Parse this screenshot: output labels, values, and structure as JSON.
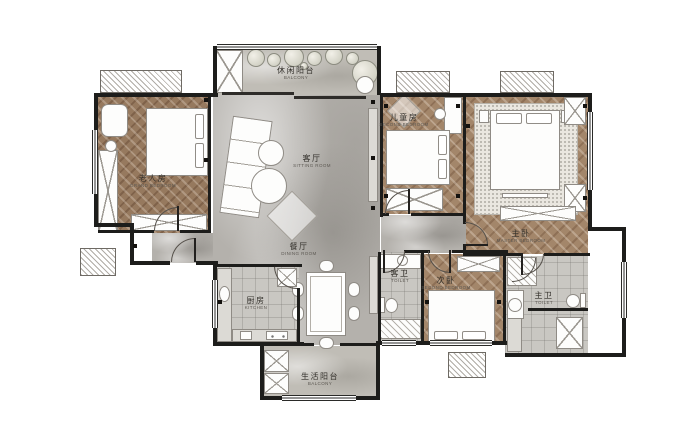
{
  "plan": {
    "rooms": [
      {
        "id": "grand-bedroom",
        "zh": "老人房",
        "en": "GRAND BEDROOM"
      },
      {
        "id": "leisure-balcony",
        "zh": "休闲阳台",
        "en": "BALCONY"
      },
      {
        "id": "sitting-room",
        "zh": "客厅",
        "en": "SITTING ROOM"
      },
      {
        "id": "kids-bedroom",
        "zh": "儿童房",
        "en": "SECOND BEDROOM"
      },
      {
        "id": "master-bedroom",
        "zh": "主卧",
        "en": "MASTER BEDROOM"
      },
      {
        "id": "dining-room",
        "zh": "餐厅",
        "en": "DINING ROOM"
      },
      {
        "id": "kitchen",
        "zh": "厨房",
        "en": "KITCHEN"
      },
      {
        "id": "guest-toilet",
        "zh": "客卫",
        "en": "TOILET"
      },
      {
        "id": "second-bedroom",
        "zh": "次卧",
        "en": "SECOND BEDROOM"
      },
      {
        "id": "master-toilet",
        "zh": "主卫",
        "en": "TOILET"
      },
      {
        "id": "life-balcony",
        "zh": "生活阳台",
        "en": "BALCONY"
      }
    ],
    "colors": {
      "wall": "#1d1d1b",
      "wood_floor": "#a3866a",
      "marble_floor": "#b4b1ac",
      "tile_floor": "#c9c7c2",
      "balcony_floor": "#c0bdb6"
    }
  }
}
